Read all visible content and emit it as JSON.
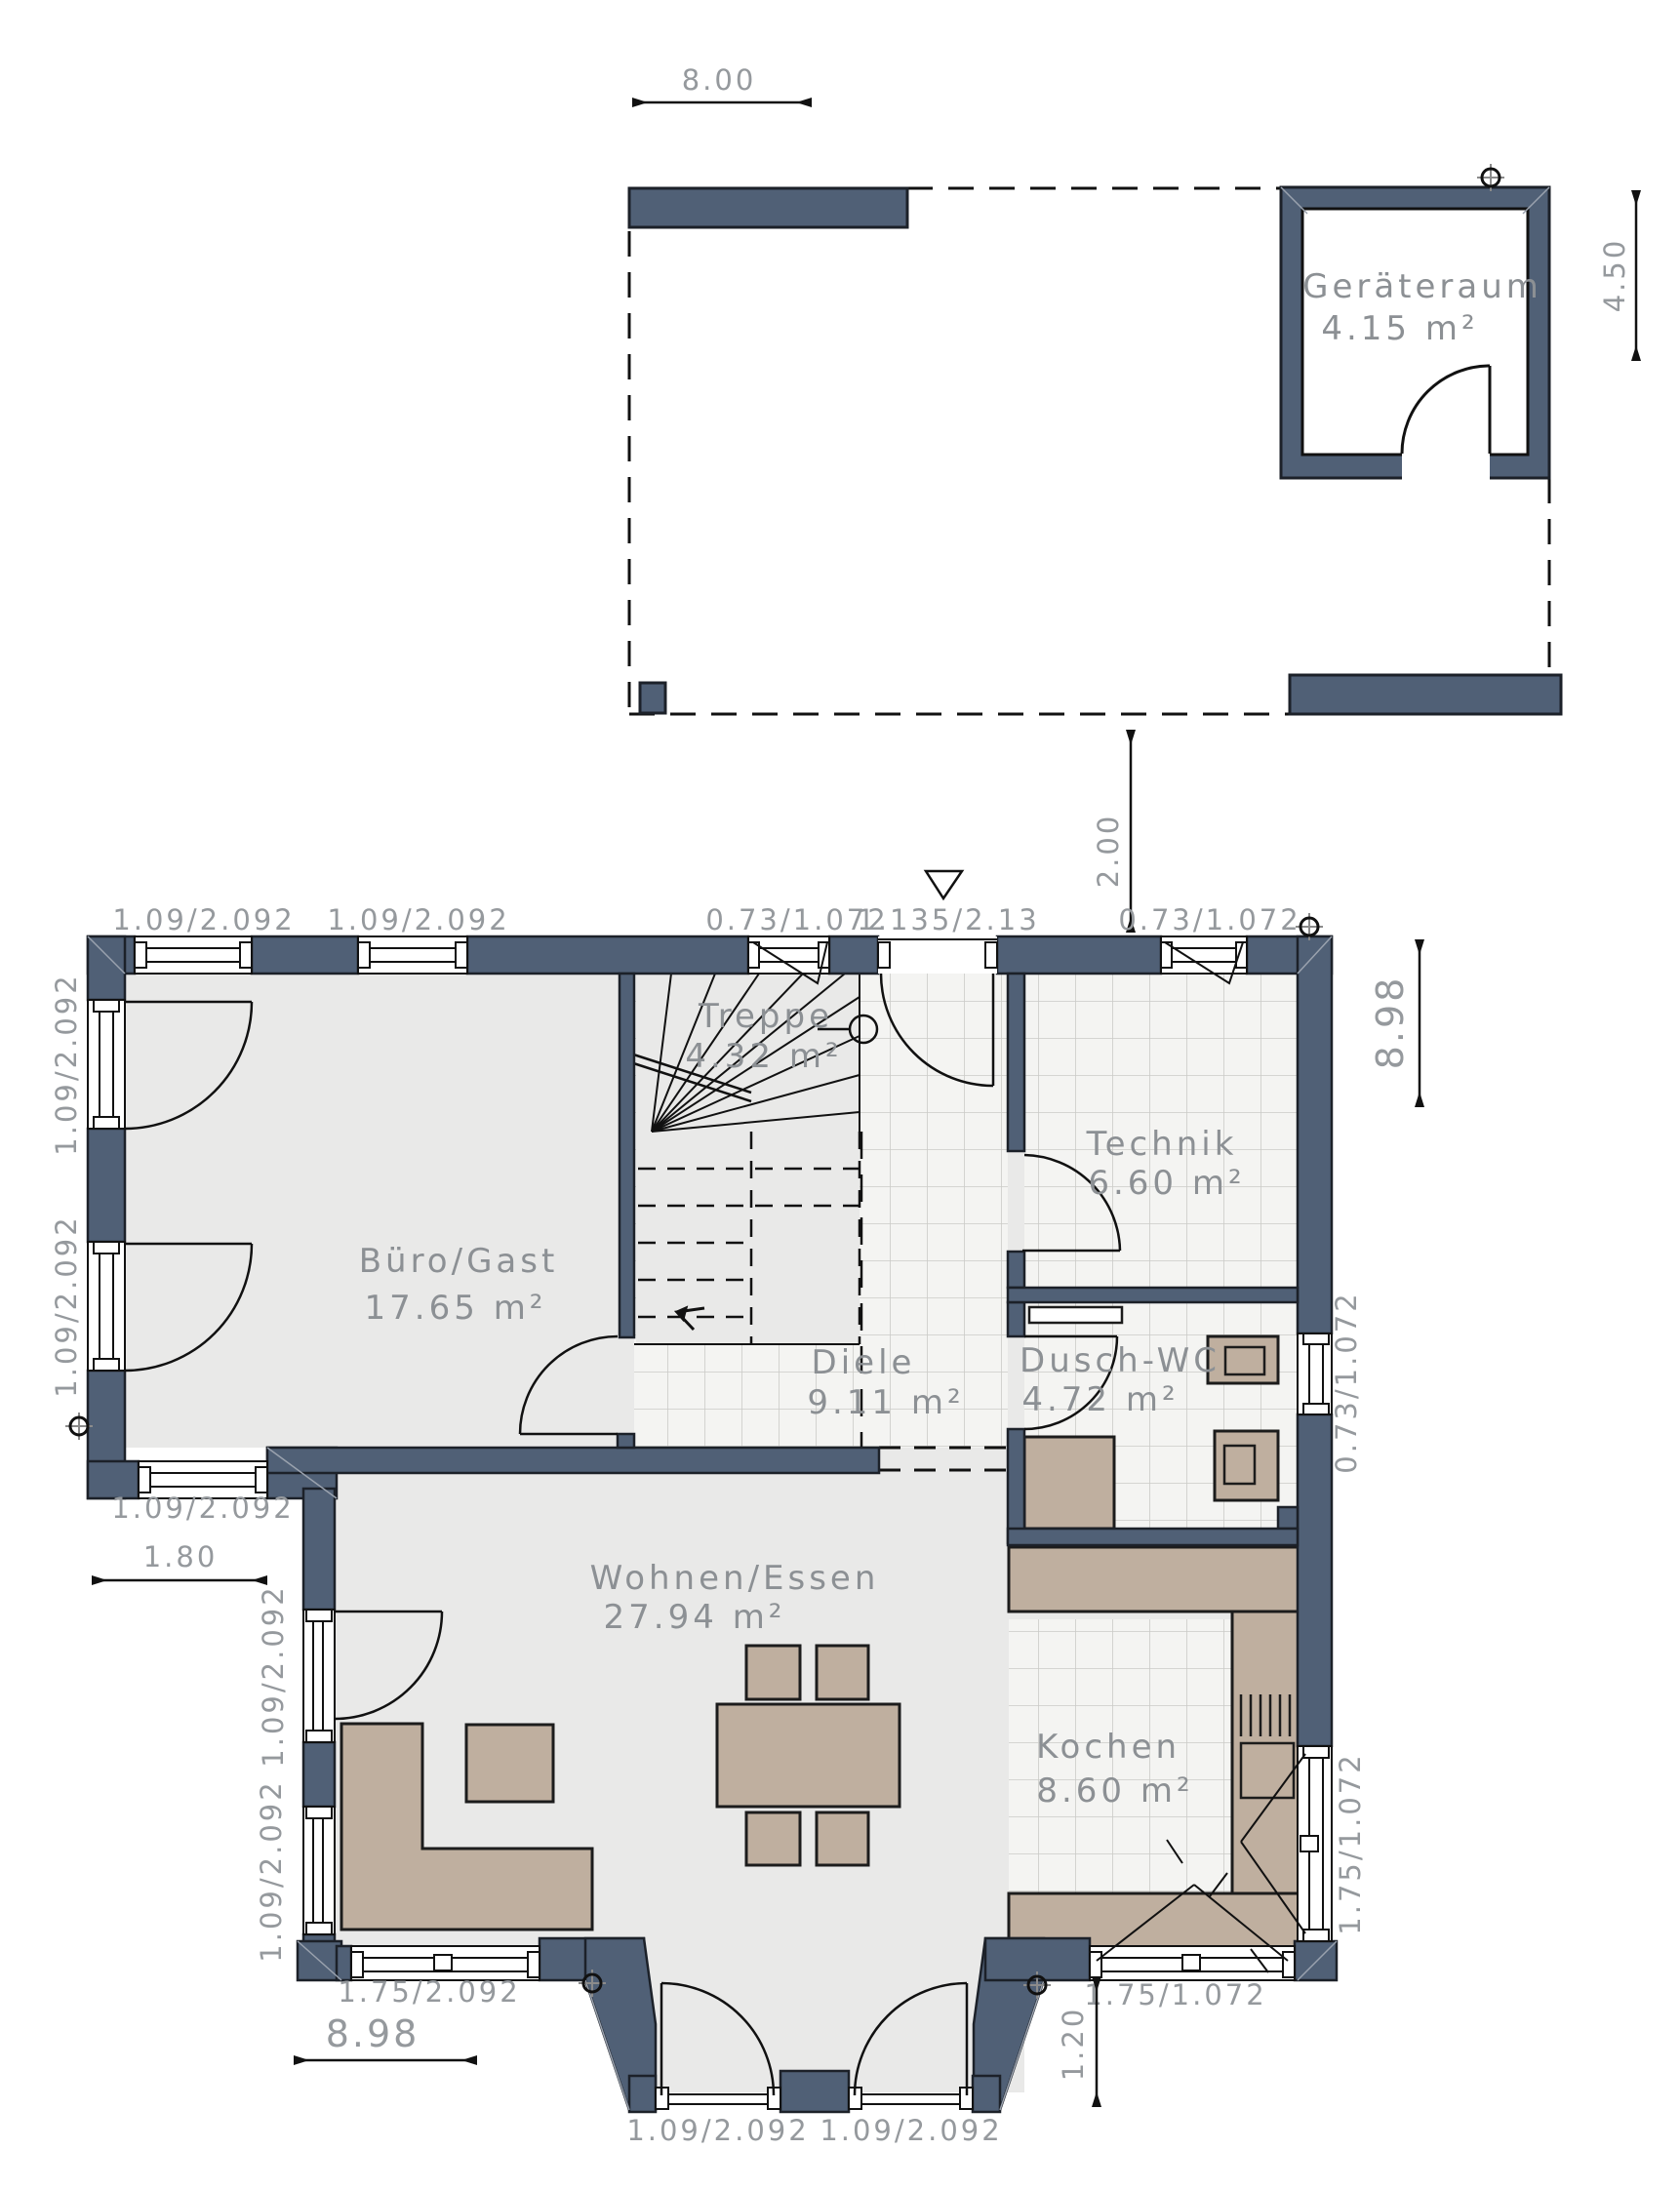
{
  "palette": {
    "wall_fill": "#506076",
    "wall_outline": "#1c2129",
    "floor": "#e9e9e8",
    "tile_bg": "#f4f4f2",
    "tile_line": "#cbcbc7",
    "furniture": "#bfaf9f",
    "furniture_outline": "#1c1c1c",
    "room_text": "#8c9094",
    "dim_text": "#95999d",
    "line": "#111111"
  },
  "rooms": {
    "geraeteraum": {
      "name": "Geräteraum",
      "area": "4.15 m²"
    },
    "buero": {
      "name": "Büro/Gast",
      "area": "17.65 m²"
    },
    "treppe": {
      "name": "Treppe",
      "area": "4.32 m²"
    },
    "technik": {
      "name": "Technik",
      "area": "6.60 m²"
    },
    "diele": {
      "name": "Diele",
      "area": "9.11 m²"
    },
    "duschwc": {
      "name": "Dusch-WC",
      "area": "4.72 m²"
    },
    "wohnen": {
      "name": "Wohnen/Essen",
      "area": "27.94 m²"
    },
    "kochen": {
      "name": "Kochen",
      "area": "8.60 m²"
    }
  },
  "dimensions": {
    "carport_width": "8.00",
    "carport_depth": "4.50",
    "gap_house_carport": "2.00",
    "house_depth_right": "8.98",
    "house_width_bottom": "8.98",
    "offset_west": "1.80",
    "bay_depth": "1.20",
    "top_win1": "1.09/2.092",
    "top_win2": "1.09/2.092",
    "top_win3": "0.73/1.072",
    "entrance_door": "1.135/2.13",
    "top_win4": "0.73/1.072",
    "west_win1": "1.09/2.092",
    "west_win2": "1.09/2.092",
    "buero_south_win": "1.09/2.092",
    "wohnen_west_win1": "1.09/2.092",
    "wohnen_west_win2": "1.09/2.092",
    "south_win_wohnen": "1.75/2.092",
    "bay_door_left": "1.09/2.092",
    "bay_door_right": "1.09/2.092",
    "south_win_kochen": "1.75/1.072",
    "east_win_duschwc": "0.73/1.072",
    "east_win_kochen": "1.75/1.072"
  }
}
